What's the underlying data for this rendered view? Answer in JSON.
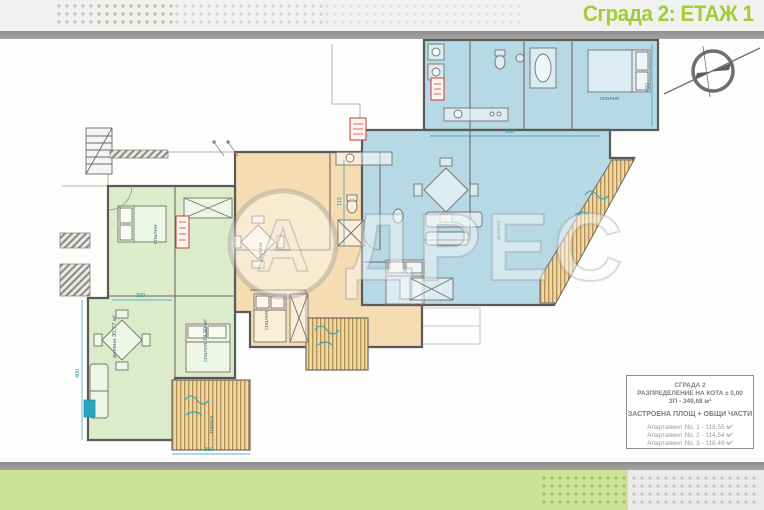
{
  "header": {
    "title": "Сграда 2: ЕТАЖ 1"
  },
  "legend_box": {
    "building": "СГРАДА 2",
    "distribution": "РАЗПРЕДЕЛЕНИЕ НА КОТА ± 0,00",
    "built_area": "ЗП - 349,68 м²",
    "section_title": "ЗАСТРОЕНА ПЛОЩ + ОБЩИ ЧАСТИ",
    "apartments": [
      {
        "label": "Апартамент No. 1 - 119,55 м²"
      },
      {
        "label": "Апартамент No. 2 - 114,54 м²"
      },
      {
        "label": "Апартамент No. 3 - 118,49 м²"
      }
    ]
  },
  "watermark": {
    "letter_a": "А",
    "rest": "ДРЕС"
  },
  "floorplan": {
    "colors": {
      "apartment_green": "#dcecca",
      "apartment_orange": "#f5dcb2",
      "apartment_blue": "#b7d9e6",
      "walls": "#5a5a5a",
      "dimension_lines": "#22a2b8",
      "stamp_red": "#c53b30",
      "title_green": "#a3cb3a"
    },
    "rooms": {
      "green_bedroom": "спалня",
      "green_living": "дневна 30,77 м²",
      "green_bedroom2": "спалня 13,30 м²",
      "orange_living": "дневна",
      "orange_bedroom": "спалня",
      "blue_living": "дневна",
      "blue_bedroom": "спалня",
      "terrace": "тераса"
    },
    "dims": {
      "d300a": "300",
      "d300b": "300",
      "d368": "368",
      "d112": "112",
      "d450": "450",
      "d400": "400"
    }
  }
}
